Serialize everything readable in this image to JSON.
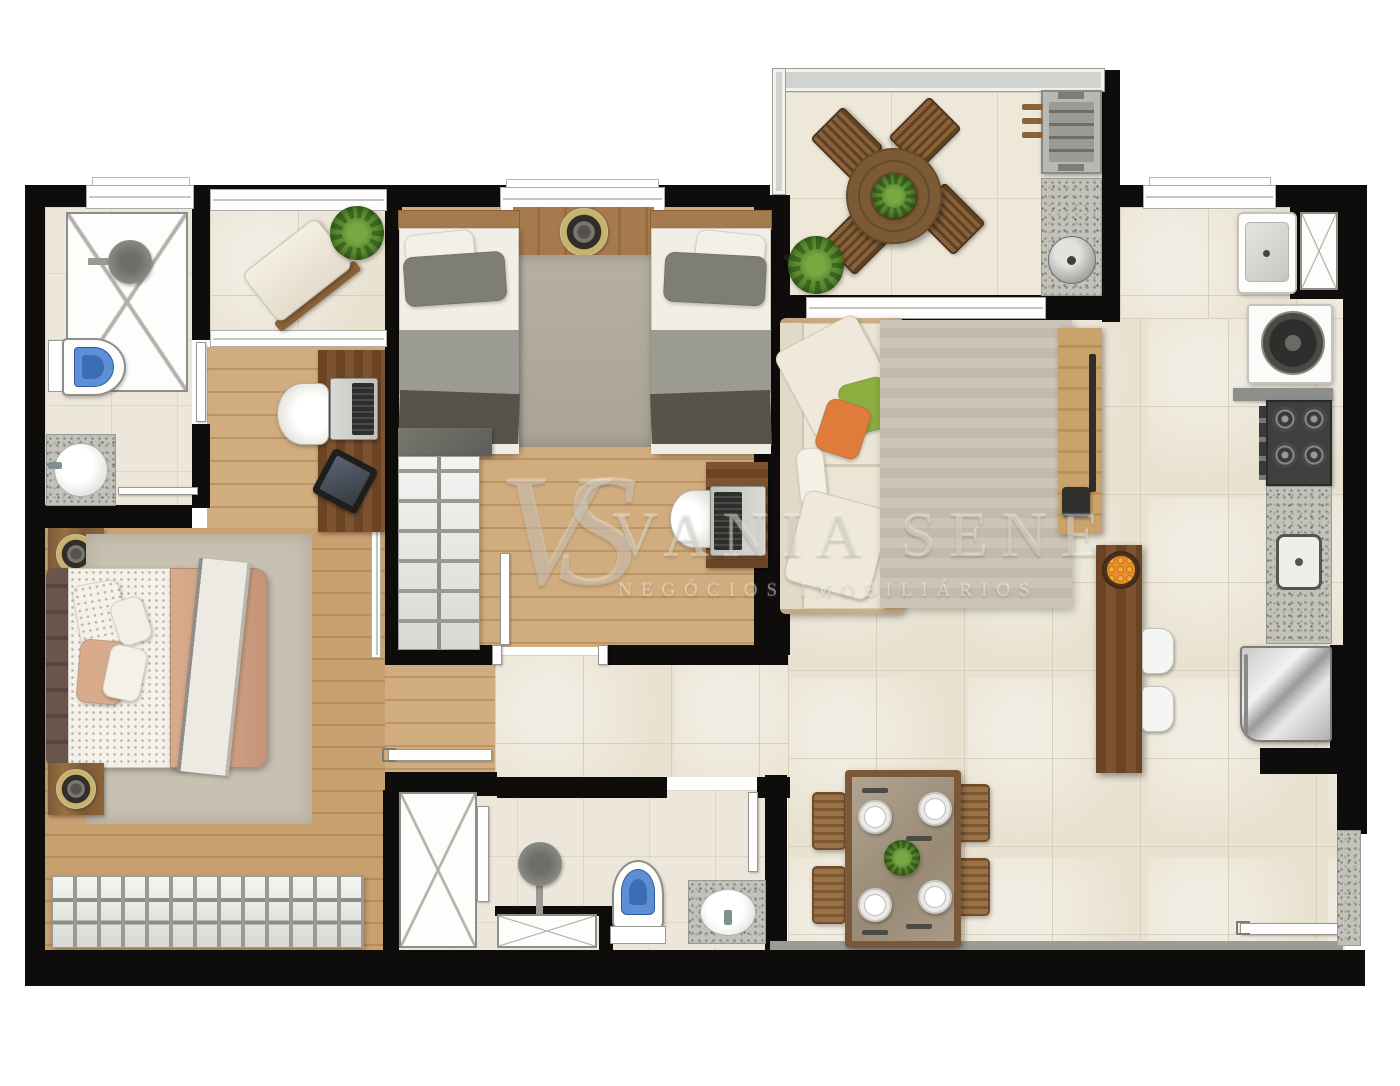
{
  "watermark": {
    "logo": "VS",
    "title": "VANIA SENE",
    "subtitle": "NEGÓCIOS IMOBILIÁRIOS"
  },
  "palette": {
    "wall": "#0e0d0b",
    "tile": "#e9e2d1",
    "tileline": "#d8cfbc",
    "tilesm": "#ece7da",
    "wood": "#c9a06f",
    "woodline": "#b58c5c",
    "wood2": "#d1ac7e",
    "wood2line": "#bd9464",
    "gold": "#c9b26a",
    "rug": "#c8c1b2",
    "cream": "#ece5d6",
    "grayblanket": "#9b9b94",
    "darkthrow": "#56534a",
    "salmon": "#d9ab8d",
    "green": "#8cad3f",
    "orange": "#df7c3c",
    "toiletblue": "#5c8fd6",
    "toiletbluedark": "#3c6cb4"
  },
  "rooms": [
    {
      "name": "suite-bathroom",
      "furniture": [
        "shower-box",
        "shower-head",
        "toilet",
        "granite-sink-counter",
        "towel-bar"
      ]
    },
    {
      "name": "private-terrace",
      "furniture": [
        "lounge-chair",
        "potted-plant"
      ]
    },
    {
      "name": "home-office-nook",
      "furniture": [
        "desk",
        "office-chair",
        "laptop",
        "tablet"
      ]
    },
    {
      "name": "master-bedroom",
      "furniture": [
        "double-bed",
        "headboard",
        "nightstand-lamp-left",
        "nightstand-lamp-right",
        "area-rug",
        "hanger-wardrobe",
        "mirror-panel",
        "sliding-door"
      ]
    },
    {
      "name": "second-bedroom",
      "furniture": [
        "twin-bed-left",
        "twin-bed-right",
        "headboard-panel",
        "ceiling-light",
        "hanger-wardrobe",
        "shelf",
        "desk",
        "office-chair",
        "laptop"
      ]
    },
    {
      "name": "hallway",
      "furniture": []
    },
    {
      "name": "social-bathroom",
      "furniture": [
        "shower-head",
        "shower-enclosure",
        "toilet",
        "granite-sink-counter",
        "linen-closet"
      ]
    },
    {
      "name": "living-room",
      "furniture": [
        "sofa",
        "throw-pillow-white",
        "throw-pillow-green",
        "throw-pillow-orange",
        "area-rug",
        "tv-panel",
        "tv",
        "media-console"
      ]
    },
    {
      "name": "dining-area",
      "furniture": [
        "dining-table",
        "dining-chair",
        "dining-chair",
        "dining-chair",
        "dining-chair",
        "place-setting",
        "place-setting",
        "place-setting",
        "place-setting",
        "centerpiece-plant"
      ]
    },
    {
      "name": "kitchen",
      "furniture": [
        "bar-counter",
        "fruit-bowl",
        "bar-stool",
        "bar-stool",
        "cooktop",
        "granite-counter",
        "counter-sink",
        "refrigerator",
        "service-door"
      ]
    },
    {
      "name": "laundry-area",
      "furniture": [
        "laundry-tank",
        "washing-machine",
        "utility-shaft"
      ]
    },
    {
      "name": "gourmet-balcony",
      "furniture": [
        "barbecue-grill",
        "skewers",
        "granite-counter-round-sink",
        "round-table",
        "table-plant",
        "balcony-chair",
        "balcony-chair",
        "balcony-chair",
        "balcony-chair",
        "potted-plant"
      ]
    }
  ]
}
